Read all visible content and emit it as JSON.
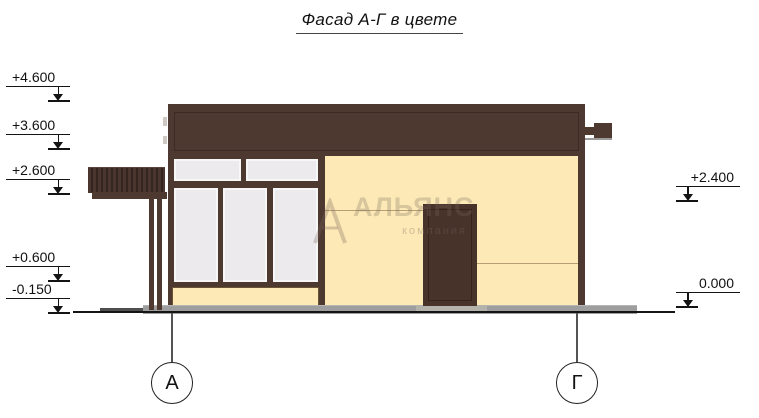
{
  "title": "Фасад А-Г в цвете",
  "levels": {
    "left": [
      {
        "label": "+4.600"
      },
      {
        "label": "+3.600"
      },
      {
        "label": "+2.600"
      },
      {
        "label": "+0.600"
      },
      {
        "label": "-0.150"
      }
    ],
    "right": [
      {
        "label": "+2.400"
      },
      {
        "label": "0.000"
      }
    ]
  },
  "axes": [
    {
      "label": "А"
    },
    {
      "label": "Г"
    }
  ],
  "watermark": {
    "name": "АЛЬЯНС",
    "subtitle": "компания"
  },
  "colors": {
    "roof": "#4e3931",
    "roof_dark": "#3c2a24",
    "wall": "#fce9b6",
    "window": "#eceaec",
    "window_edge": "#f8f7f8",
    "door": "#48332b",
    "door_dark": "#352419",
    "plinth": "#9e9e9e",
    "ink": "#141414",
    "joint": "#b89d77"
  }
}
